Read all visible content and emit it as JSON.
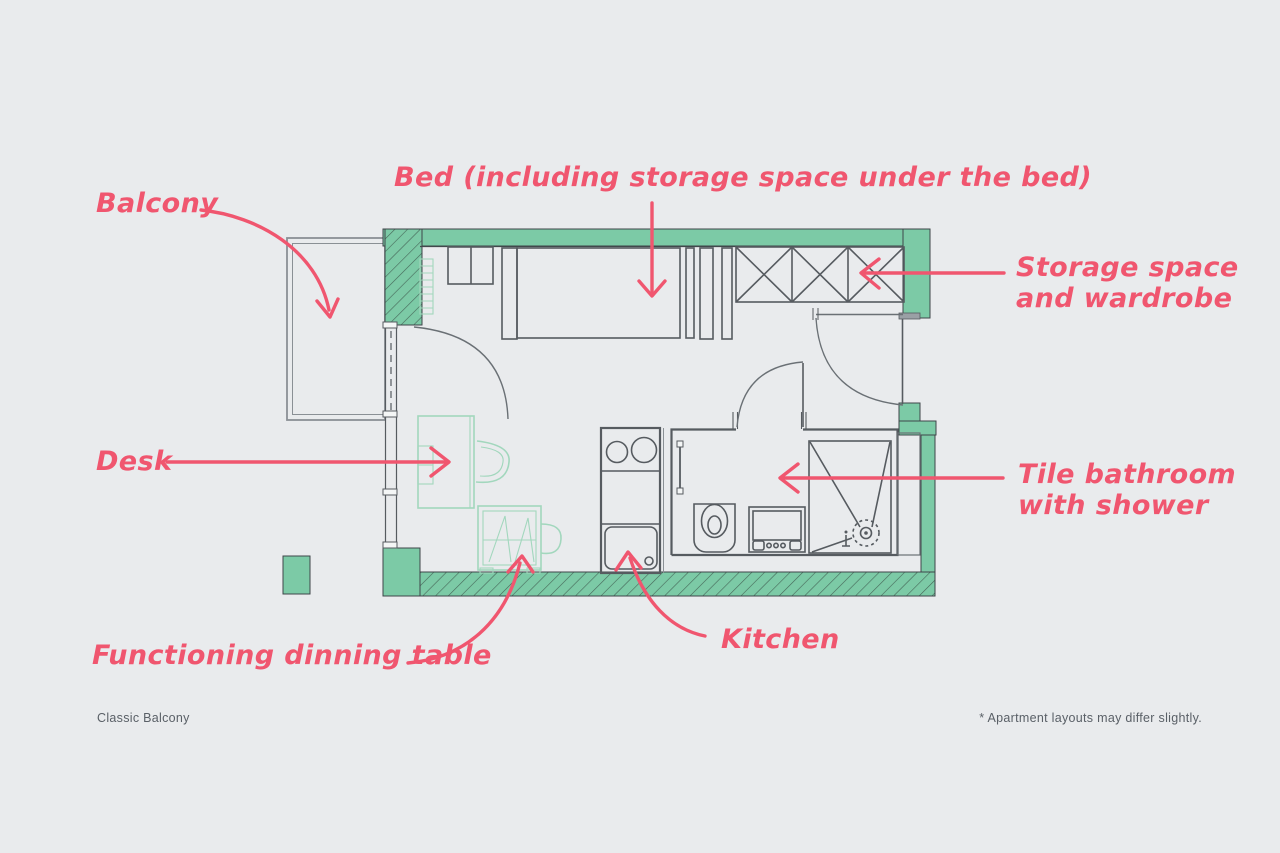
{
  "title": "Apartment floor plan — Classic Balcony",
  "colors": {
    "background": "#e9ebed",
    "wall_teal": "#7ccaa6",
    "wall_outline": "#3e4549",
    "plan_line": "#565b60",
    "furniture_teal": "#a2d7bd",
    "annotation_pink": "#f0566f",
    "footer_text": "#5a6067"
  },
  "annotations": {
    "balcony": "Balcony",
    "bed": "Bed (including storage space under the bed)",
    "storage": "Storage space\nand wardrobe",
    "desk": "Desk",
    "bathroom": "Tile bathroom\nwith shower",
    "dining_table": "Functioning dinning table",
    "kitchen": "Kitchen"
  },
  "footer": {
    "left": "Classic Balcony",
    "right": "* Apartment layouts may differ slightly."
  }
}
